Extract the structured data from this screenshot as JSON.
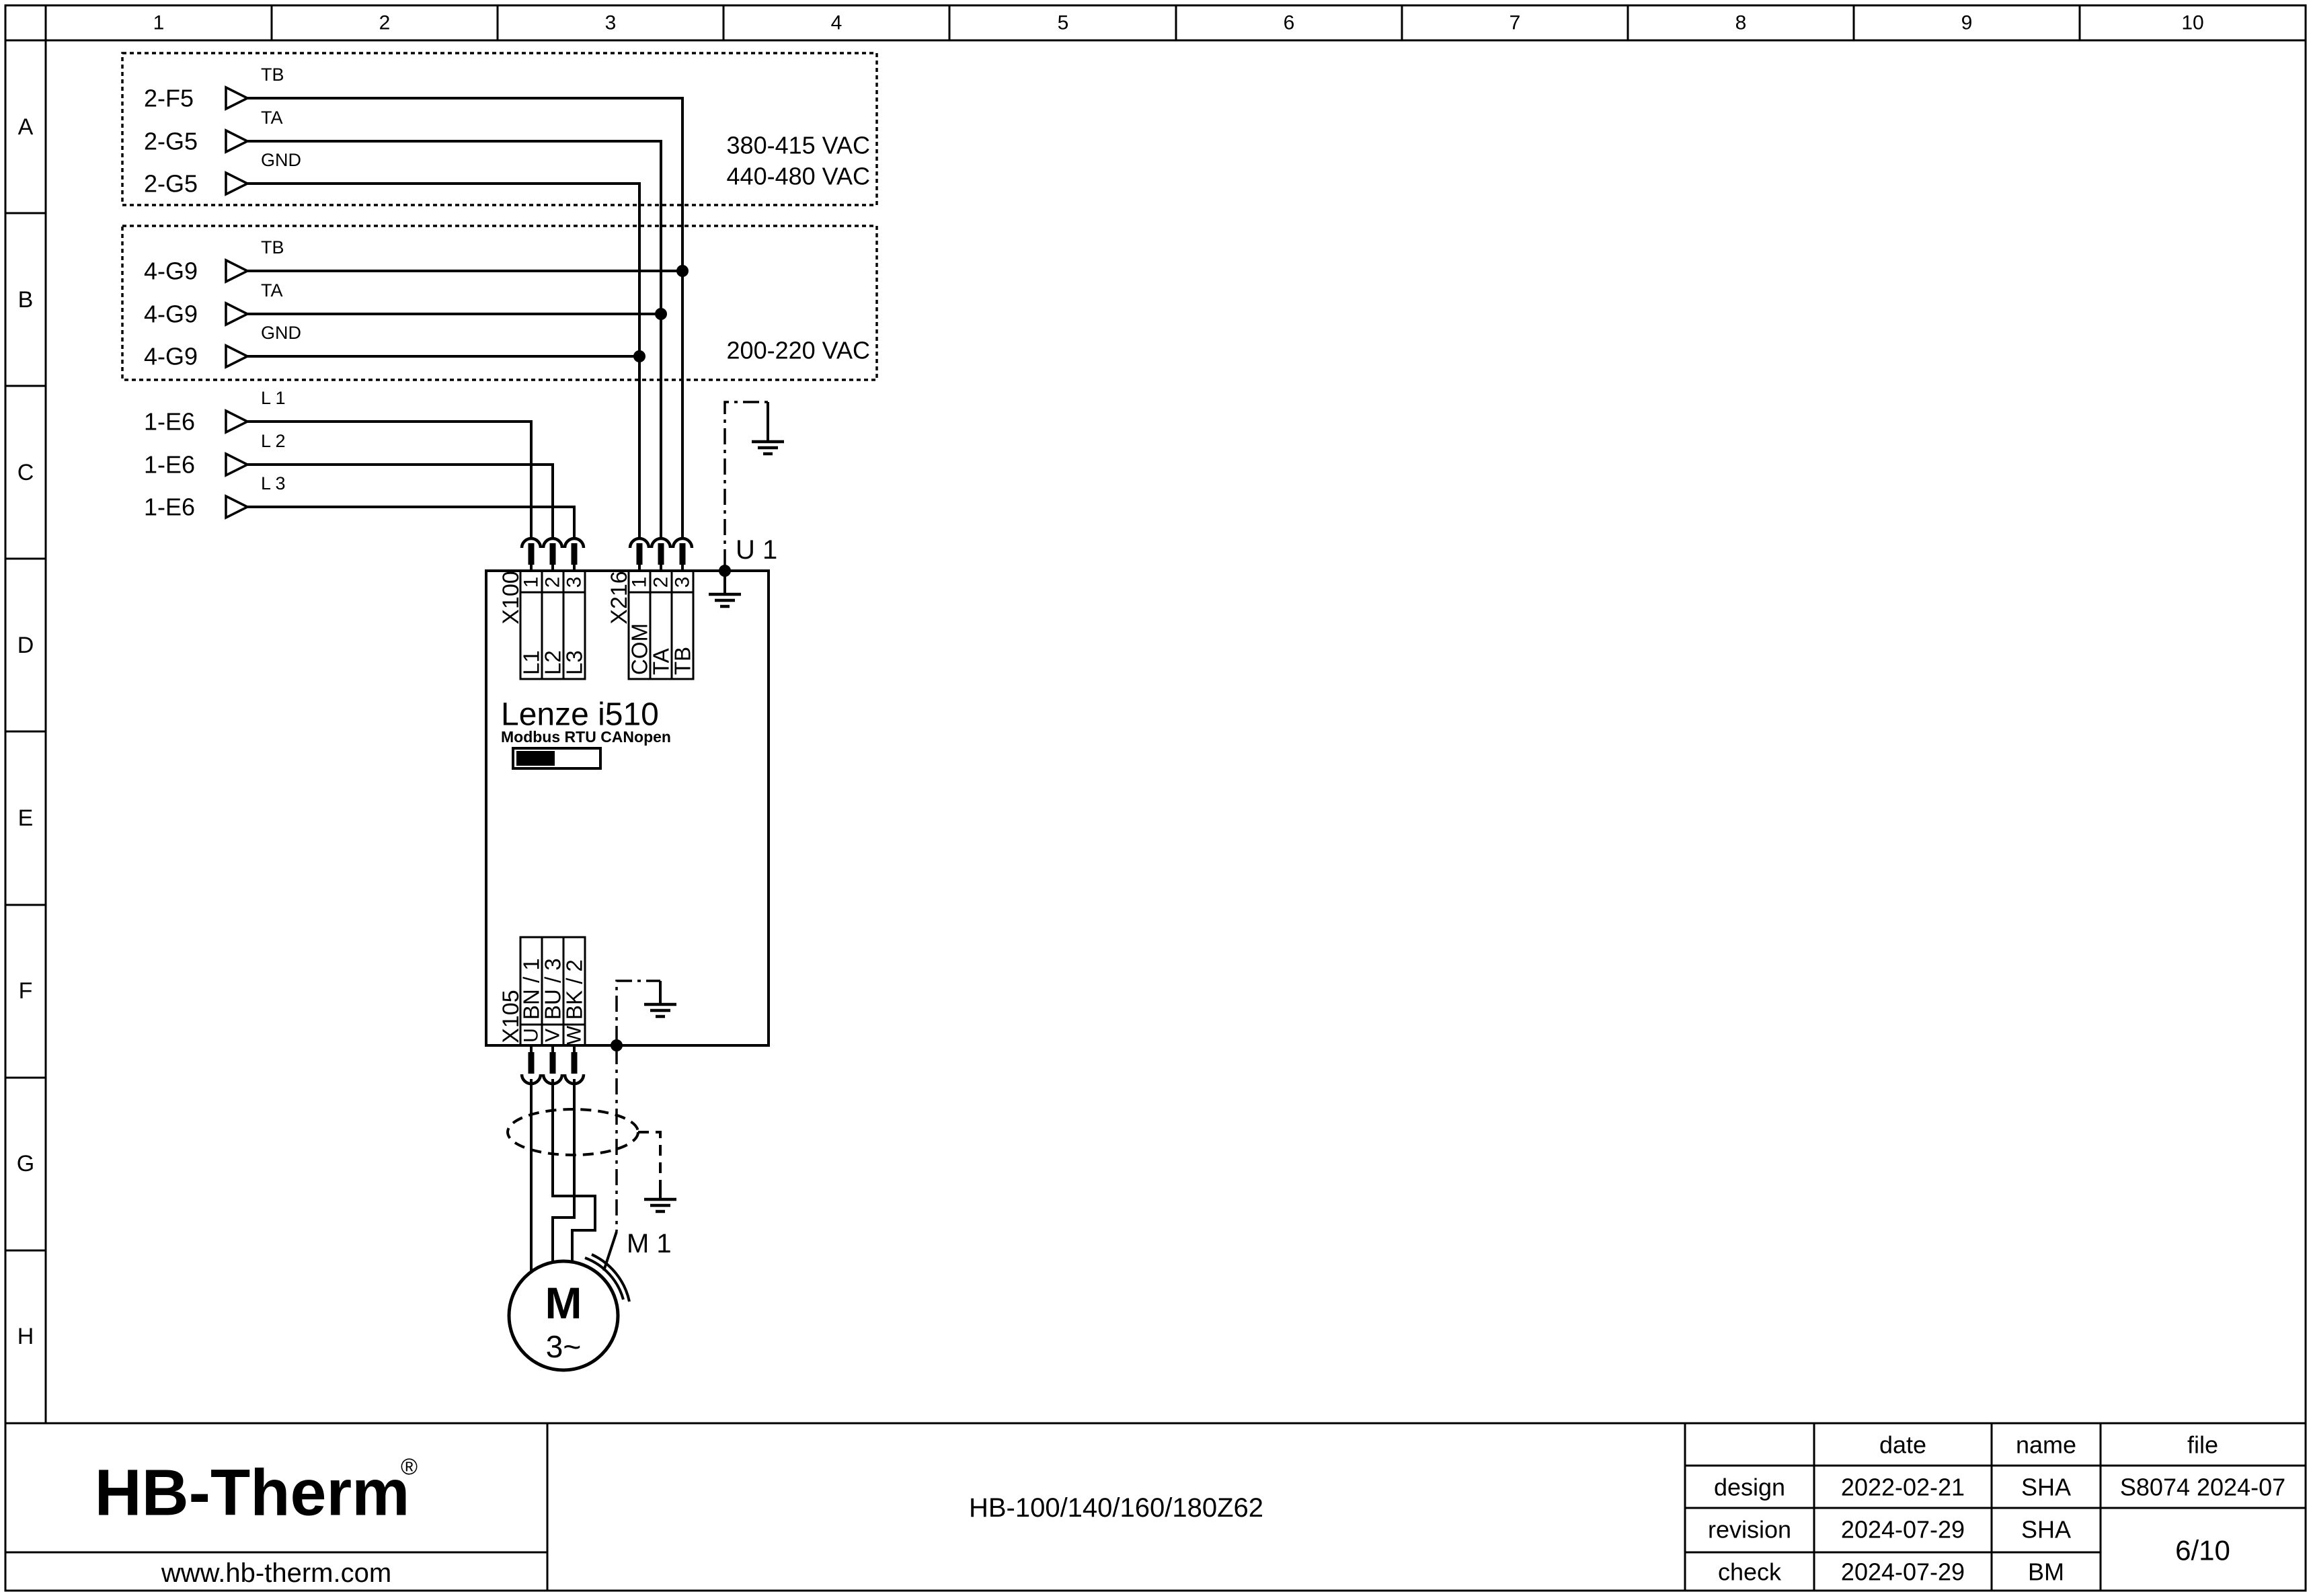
{
  "ruler": {
    "columns": [
      "1",
      "2",
      "3",
      "4",
      "5",
      "6",
      "7",
      "8",
      "9",
      "10"
    ],
    "rows": [
      "A",
      "B",
      "C",
      "D",
      "E",
      "F",
      "G",
      "H"
    ]
  },
  "source_groups": [
    {
      "labels": [
        "2-F5",
        "2-G5",
        "2-G5"
      ],
      "signals": [
        "TB",
        "TA",
        "GND"
      ],
      "voltages": [
        "380-415 VAC",
        "440-480 VAC"
      ]
    },
    {
      "labels": [
        "4-G9",
        "4-G9",
        "4-G9"
      ],
      "signals": [
        "TB",
        "TA",
        "GND"
      ],
      "voltages": [
        "200-220 VAC"
      ]
    },
    {
      "labels": [
        "1-E6",
        "1-E6",
        "1-E6"
      ],
      "signals": [
        "L 1",
        "L 2",
        "L 3"
      ],
      "voltages": []
    }
  ],
  "drive": {
    "designator": "U 1",
    "name": "Lenze i510",
    "comm": "Modbus RTU CANopen",
    "x100": {
      "label": "X100",
      "pins": [
        "1",
        "2",
        "3"
      ],
      "wires": [
        "L1",
        "L2",
        "L3"
      ]
    },
    "x216": {
      "label": "X216",
      "pins": [
        "1",
        "2",
        "3"
      ],
      "wires": [
        "COM",
        "TA",
        "TB"
      ]
    },
    "x105": {
      "label": "X105",
      "pins": [
        "U",
        "V",
        "W"
      ],
      "wires": [
        "BN / 1",
        "BU / 3",
        "BK / 2"
      ]
    }
  },
  "motor": {
    "designator": "M 1",
    "letter": "M",
    "phases": "3~"
  },
  "title_block": {
    "logo_text": "HB-Therm",
    "logo_reg": "®",
    "logo_color": "#20294c",
    "website": "www.hb-therm.com",
    "doc_title": "HB-100/140/160/180Z62",
    "col_headers": [
      "date",
      "name",
      "file"
    ],
    "rows": [
      {
        "label": "design",
        "date": "2022-02-21",
        "name": "SHA"
      },
      {
        "label": "revision",
        "date": "2024-07-29",
        "name": "SHA"
      },
      {
        "label": "check",
        "date": "2024-07-29",
        "name": "BM"
      }
    ],
    "file_no": "S8074 2024-07",
    "sheet": "6/10"
  }
}
